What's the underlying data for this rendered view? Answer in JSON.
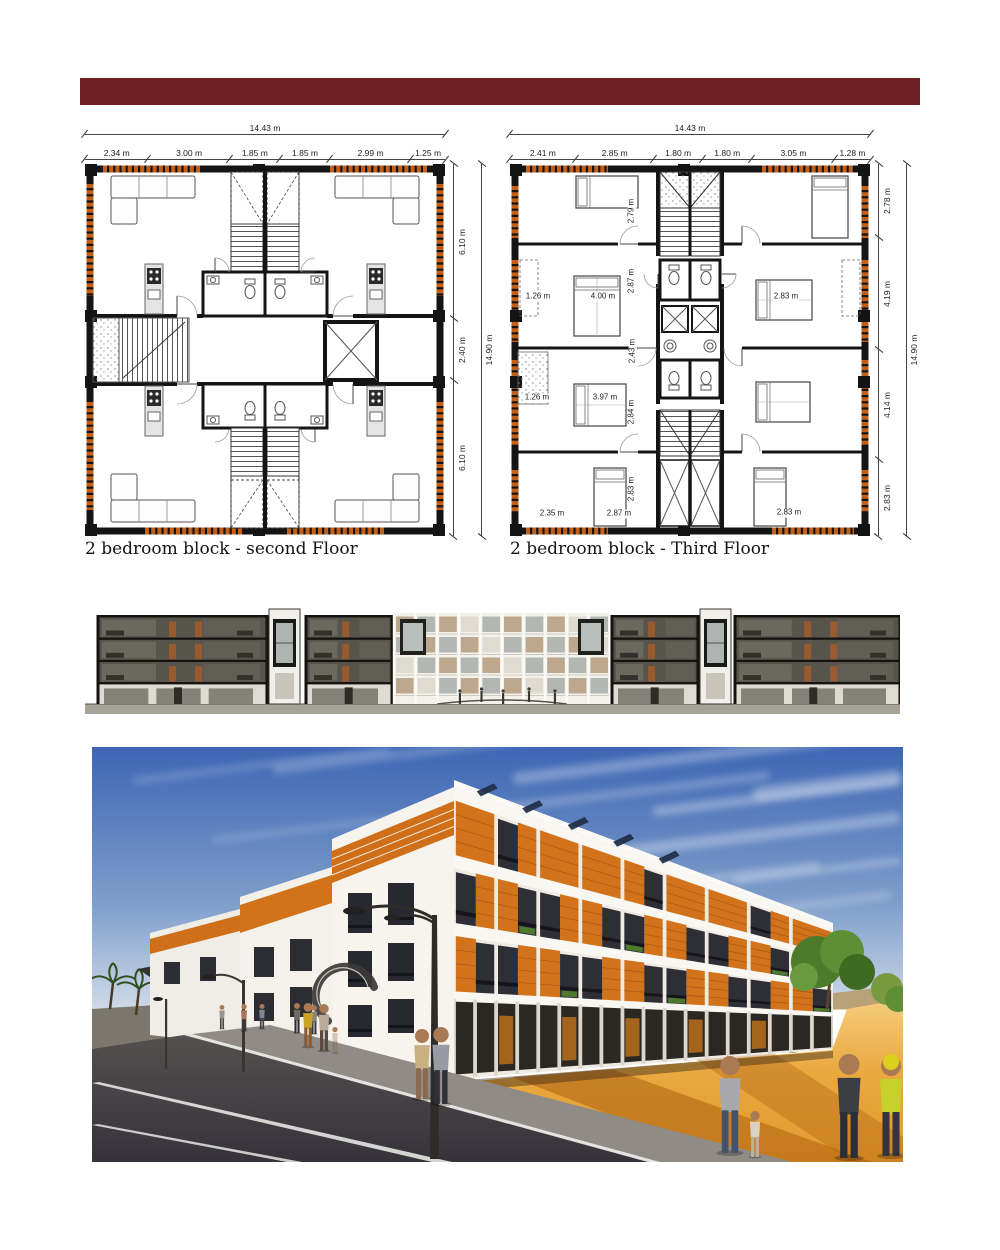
{
  "page": {
    "accent_color": "#6e2023",
    "facade_orange": "#d2731c"
  },
  "plans": [
    {
      "caption": "2 bedroom block - second Floor",
      "overall_width": "14.43 m",
      "overall_height": "14.90 m",
      "top_dims": [
        "2.34 m",
        "3.00 m",
        "1.85 m",
        "1.85 m",
        "2.99 m",
        "1.25 m"
      ],
      "side_dims": [
        "6.10 m",
        "2.40 m",
        "6.10 m"
      ]
    },
    {
      "caption": "2 bedroom block - Third Floor",
      "overall_width": "14.43 m",
      "overall_height": "14.90 m",
      "top_dims": [
        "2.41 m",
        "2.85 m",
        "1.80 m",
        "1.80 m",
        "3.05 m",
        "1.28 m"
      ],
      "side_dims": [
        "2.78 m",
        "4.19 m",
        "4.14 m",
        "2.83 m"
      ],
      "interior_dims": [
        "2.79 m",
        "2.87 m",
        "1.26 m",
        "4.00 m",
        "2.83 m",
        "2.43 m",
        "1.26 m",
        "3.97 m",
        "2.84 m",
        "2.83 m",
        "2.35 m",
        "2.87 m",
        "2.83 m"
      ]
    }
  ]
}
